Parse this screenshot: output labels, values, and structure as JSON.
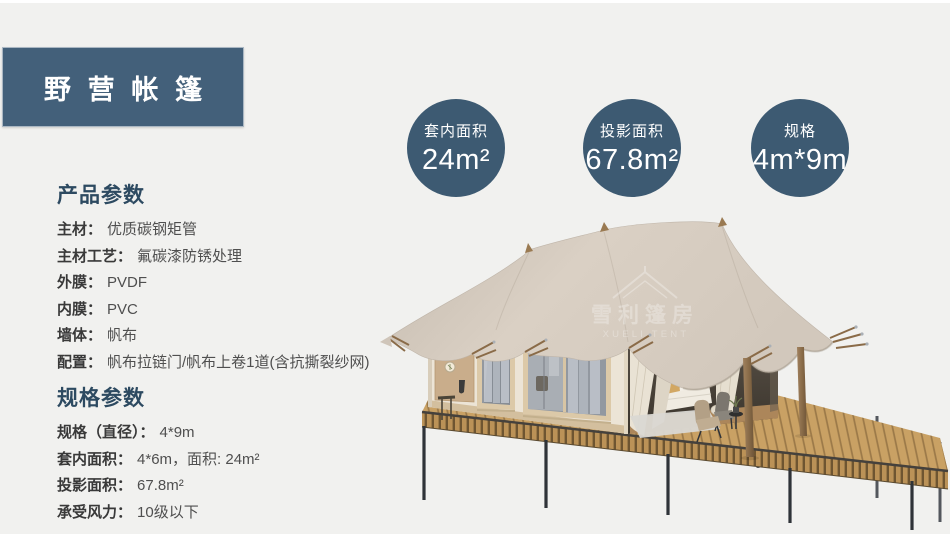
{
  "page": {
    "background": "#f1f1ef",
    "top_strip_color": "#ffffff"
  },
  "header": {
    "title": "野营帐篷",
    "bg": "#43607a",
    "text_color": "#ffffff"
  },
  "badges": [
    {
      "label": "套内面积",
      "value": "24m²"
    },
    {
      "label": "投影面积",
      "value": "67.8m²"
    },
    {
      "label": "规格",
      "value": "4m*9m"
    }
  ],
  "sections": [
    {
      "title": "产品参数",
      "rows": [
        {
          "label": "主材：",
          "value": "优质碳钢矩管"
        },
        {
          "label": "主材工艺：",
          "value": "氟碳漆防锈处理"
        },
        {
          "label": "外膜：",
          "value": "PVDF"
        },
        {
          "label": "内膜：",
          "value": "PVC"
        },
        {
          "label": "墙体：",
          "value": "帆布"
        },
        {
          "label": "配置：",
          "value": "帆布拉链门/帆布上卷1道(含抗撕裂纱网)"
        }
      ]
    },
    {
      "title": "规格参数",
      "rows": [
        {
          "label": "规格（直径）：",
          "value": "4*9m"
        },
        {
          "label": "套内面积：",
          "value": "4*6m，面积: 24m²"
        },
        {
          "label": "投影面积：",
          "value": "67.8m²"
        },
        {
          "label": "承受风力：",
          "value": "10级以下"
        }
      ]
    }
  ],
  "illustration": {
    "watermark_cn": "雪利篷房",
    "watermark_en": "XUELI TENT"
  },
  "colors": {
    "accent_circle": "#3d5a72",
    "header_bg": "#43607a",
    "section_title": "#2d4a61",
    "canopy": "#d7cdc1",
    "deck_wood": "#c9a164"
  }
}
